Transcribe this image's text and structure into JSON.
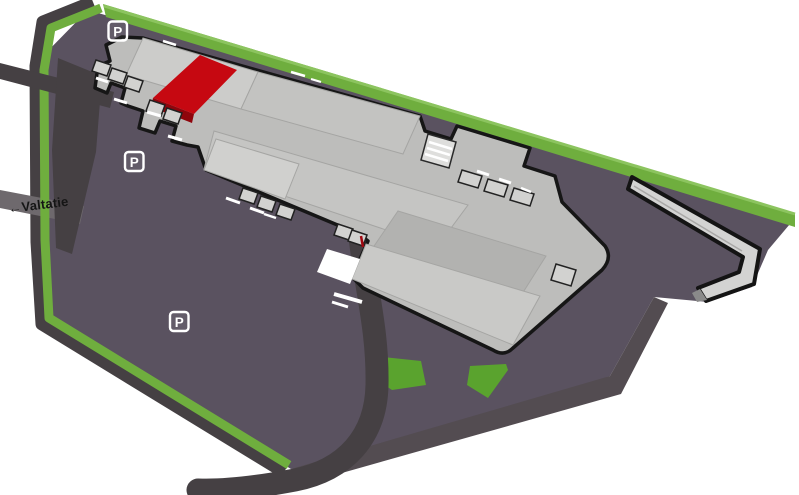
{
  "map": {
    "type": "isometric-site-plan",
    "road_label": "←Valtatie",
    "highlighted_unit": "red-highlighted-building-section"
  },
  "parking": {
    "signs": [
      {
        "label": "P"
      },
      {
        "label": "P"
      },
      {
        "label": "P"
      }
    ]
  },
  "colors": {
    "background": "#ffffff",
    "asphalt_lot": "#5a5260",
    "lot_side_face": "#534c51",
    "road_dark": "#454043",
    "road_valtatie": "#6e696d",
    "grass_green": "#6fae3e",
    "grass_green_light": "#8cc45f",
    "building_base": "#bdbdbb",
    "building_roof_light": "#ccccca",
    "building_outline": "#161616",
    "highlight_red": "#c60811",
    "highlight_red_dark": "#8f050c",
    "marking_white": "#ffffff",
    "sign_white": "#ffffff"
  }
}
